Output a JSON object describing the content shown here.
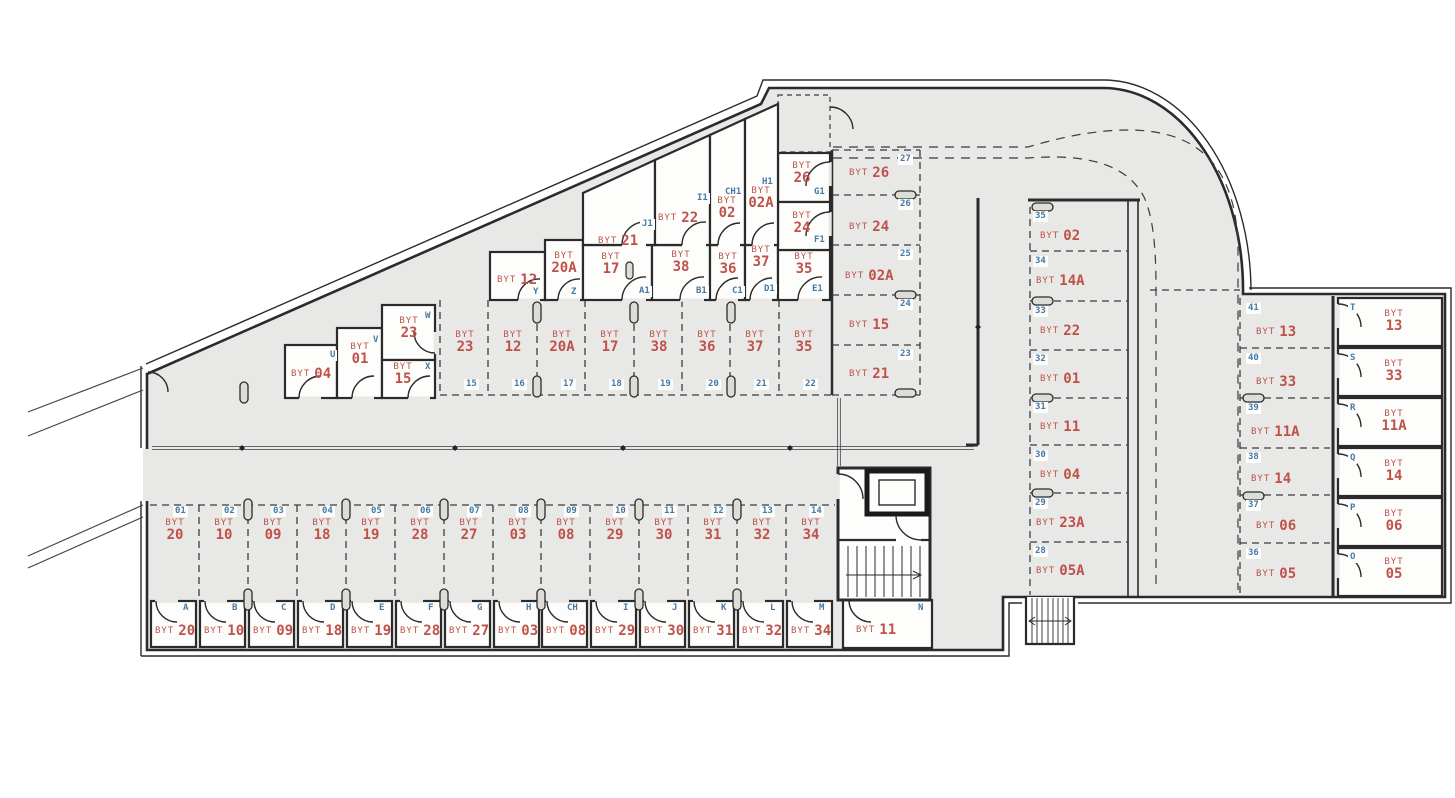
{
  "unit_prefix": "BYT",
  "colors": {
    "floor": "#e8e8e6",
    "wall": "#2b2b2b",
    "unit_label": "#bf5149",
    "code_label": "#4579a5",
    "room_fill": "#fdfdfc"
  },
  "parking_bottom": [
    {
      "space": "01",
      "unit": "20"
    },
    {
      "space": "02",
      "unit": "10"
    },
    {
      "space": "03",
      "unit": "09"
    },
    {
      "space": "04",
      "unit": "18"
    },
    {
      "space": "05",
      "unit": "19"
    },
    {
      "space": "06",
      "unit": "28"
    },
    {
      "space": "07",
      "unit": "27"
    },
    {
      "space": "08",
      "unit": "03"
    },
    {
      "space": "09",
      "unit": "08"
    },
    {
      "space": "10",
      "unit": "29"
    },
    {
      "space": "11",
      "unit": "30"
    },
    {
      "space": "12",
      "unit": "31"
    },
    {
      "space": "13",
      "unit": "32"
    },
    {
      "space": "14",
      "unit": "34"
    }
  ],
  "parking_middle": [
    {
      "space": "15",
      "unit": "23"
    },
    {
      "space": "16",
      "unit": "12"
    },
    {
      "space": "17",
      "unit": "20A"
    },
    {
      "space": "18",
      "unit": "17"
    },
    {
      "space": "19",
      "unit": "38"
    },
    {
      "space": "20",
      "unit": "36"
    },
    {
      "space": "21",
      "unit": "37"
    },
    {
      "space": "22",
      "unit": "35"
    }
  ],
  "parking_col_inner": [
    {
      "space": "27",
      "unit": "26"
    },
    {
      "space": "26",
      "unit": "24"
    },
    {
      "space": "25",
      "unit": "02A"
    },
    {
      "space": "24",
      "unit": "15"
    },
    {
      "space": "23",
      "unit": "21"
    }
  ],
  "parking_col_center": [
    {
      "space": "35",
      "unit": "02"
    },
    {
      "space": "34",
      "unit": "14A"
    },
    {
      "space": "33",
      "unit": "22"
    },
    {
      "space": "32",
      "unit": "01"
    },
    {
      "space": "31",
      "unit": "11"
    },
    {
      "space": "30",
      "unit": "04"
    },
    {
      "space": "29",
      "unit": "23A"
    },
    {
      "space": "28",
      "unit": "05A"
    }
  ],
  "parking_col_right": [
    {
      "space": "41",
      "unit": "13"
    },
    {
      "space": "40",
      "unit": "33"
    },
    {
      "space": "39",
      "unit": "11A"
    },
    {
      "space": "38",
      "unit": "14"
    },
    {
      "space": "37",
      "unit": "06"
    },
    {
      "space": "36",
      "unit": "05"
    }
  ],
  "cellars_bottom": [
    {
      "code": "A",
      "unit": "20"
    },
    {
      "code": "B",
      "unit": "10"
    },
    {
      "code": "C",
      "unit": "09"
    },
    {
      "code": "D",
      "unit": "18"
    },
    {
      "code": "E",
      "unit": "19"
    },
    {
      "code": "F",
      "unit": "28"
    },
    {
      "code": "G",
      "unit": "27"
    },
    {
      "code": "H",
      "unit": "03"
    },
    {
      "code": "CH",
      "unit": "08"
    },
    {
      "code": "I",
      "unit": "29"
    },
    {
      "code": "J",
      "unit": "30"
    },
    {
      "code": "K",
      "unit": "31"
    },
    {
      "code": "L",
      "unit": "32"
    },
    {
      "code": "M",
      "unit": "34"
    },
    {
      "code": "N",
      "unit": "11"
    }
  ],
  "cellars_right": [
    {
      "code": "T",
      "unit": "13"
    },
    {
      "code": "S",
      "unit": "33"
    },
    {
      "code": "R",
      "unit": "11A"
    },
    {
      "code": "Q",
      "unit": "14"
    },
    {
      "code": "P",
      "unit": "06"
    },
    {
      "code": "O",
      "unit": "05"
    }
  ],
  "cellars_diagonal": [
    {
      "code": "U",
      "unit": "04"
    },
    {
      "code": "V",
      "unit": "01"
    },
    {
      "code": "W",
      "unit": "23"
    },
    {
      "code": "X",
      "unit": "15"
    },
    {
      "code": "Y",
      "unit": "12"
    },
    {
      "code": "Z",
      "unit": "20A"
    },
    {
      "code": "A1",
      "unit": "17"
    },
    {
      "code": "B1",
      "unit": "38"
    },
    {
      "code": "C1",
      "unit": "36"
    },
    {
      "code": "D1",
      "unit": "37"
    },
    {
      "code": "E1",
      "unit": "35"
    },
    {
      "code": "J1",
      "unit": "21"
    },
    {
      "code": "I1",
      "unit": "22"
    },
    {
      "code": "CH1",
      "unit": "02"
    },
    {
      "code": "H1",
      "unit": "02A"
    },
    {
      "code": "G1",
      "unit": "26"
    },
    {
      "code": "F1",
      "unit": "24"
    }
  ]
}
